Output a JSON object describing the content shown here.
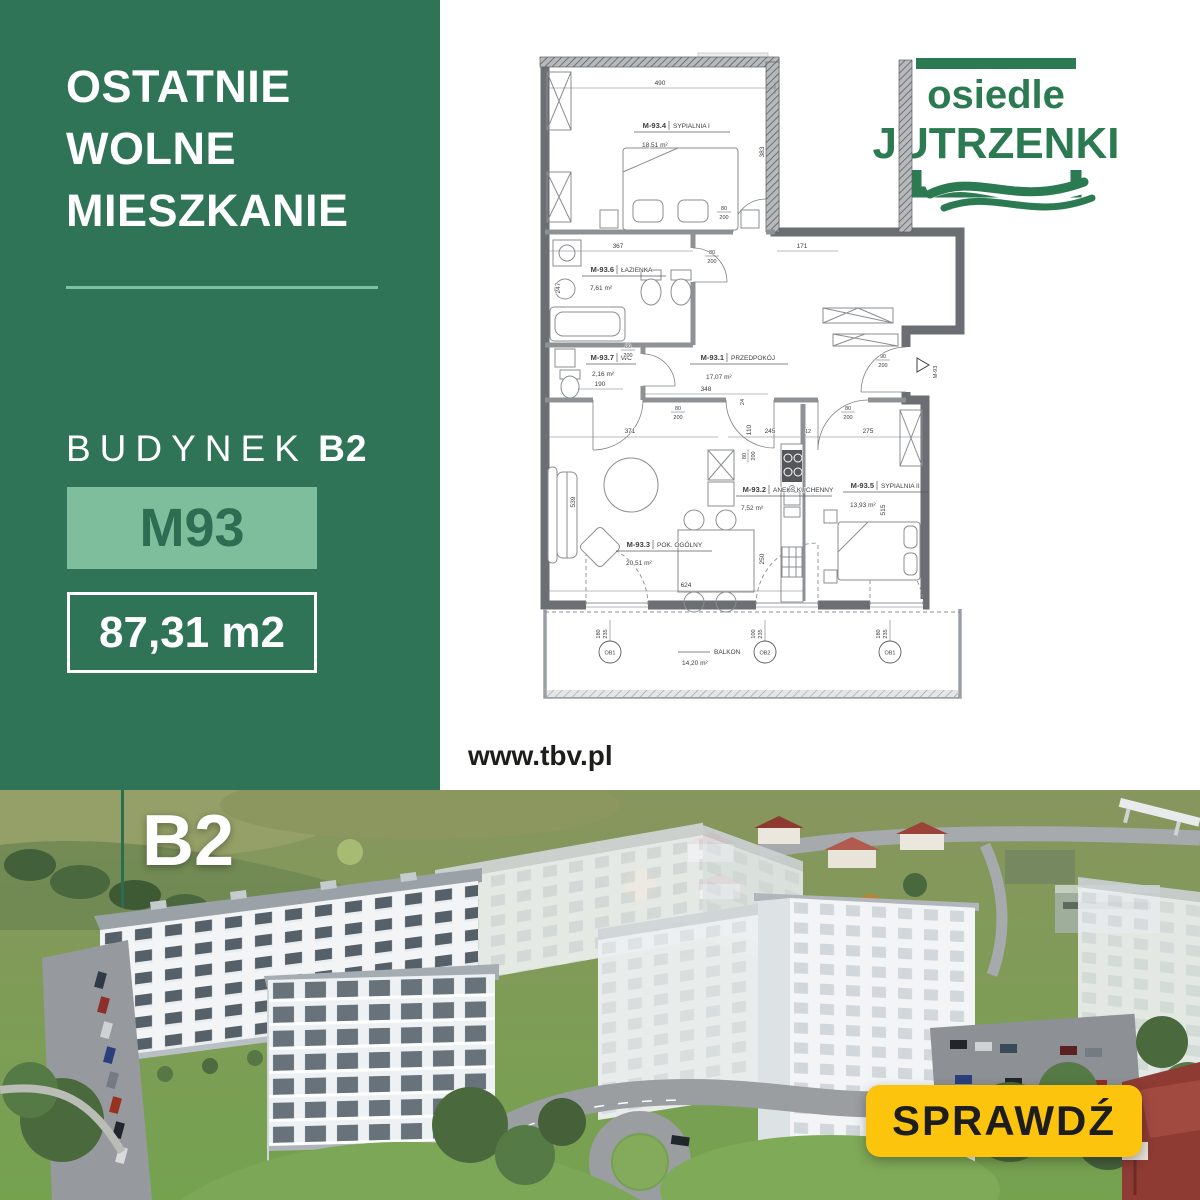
{
  "colors": {
    "brand_green": "#307458",
    "light_green": "#7fbe9d",
    "logo_green": "#2c7a52",
    "cta_yellow": "#fdc40e"
  },
  "brand": {
    "line1": "osiedle",
    "line2": "JUTRZENKI"
  },
  "sidebar": {
    "headline_lines": [
      "OSTATNIE",
      "WOLNE",
      "MIESZKANIE"
    ],
    "building_label": "BUDYNEK",
    "building_value": "B2",
    "unit_badge": "M93",
    "area_badge": "87,31 m2"
  },
  "website": "www.tbv.pl",
  "photo": {
    "building_label": "B2",
    "cta": "SPRAWDŹ"
  },
  "floor_plan": {
    "rooms": [
      {
        "id": "M-93.4",
        "name": "SYPIALNIA I",
        "area": "18,51 m²"
      },
      {
        "id": "M-93.6",
        "name": "ŁAZIENKA",
        "area": "7,61 m²"
      },
      {
        "id": "M-93.7",
        "name": "WC",
        "area": "2,16 m²"
      },
      {
        "id": "M-93.1",
        "name": "PRZEDPOKÓJ",
        "area": "17,07 m²"
      },
      {
        "id": "M-93.3",
        "name": "POK. OGÓLNY",
        "area": "20,51 m²"
      },
      {
        "id": "M-93.2",
        "name": "ANEKS KUCHENNY",
        "area": "7,52 m²"
      },
      {
        "id": "M-93.5",
        "name": "SYPIALNIA II",
        "area": "13,93 m²"
      }
    ],
    "balcony": {
      "name": "BALKON",
      "area": "14,20 m²"
    },
    "dims": {
      "top_width": "490",
      "bed1_height": "383",
      "bath_width": "367",
      "hall_top": "171",
      "bath_height": "247",
      "wc_width": "190",
      "hall_width": "348",
      "hall_gap": "24",
      "living_width": "371",
      "kitchen_clear": "110",
      "kitchen_width": "245",
      "joint": "12",
      "bed2_width": "275",
      "living_height": "539",
      "bed2_height": "515",
      "table_depth": "250",
      "living_bottom": "624"
    },
    "door_small": {
      "w": "80",
      "h": "200"
    },
    "door_entry": {
      "w": "90",
      "h": "200"
    },
    "balcony_marks": [
      "OB1",
      "OB2",
      "OB1"
    ],
    "balcony_dims": {
      "side": "180",
      "mid": "100",
      "h": "235"
    },
    "unit_mark": "M-93"
  }
}
